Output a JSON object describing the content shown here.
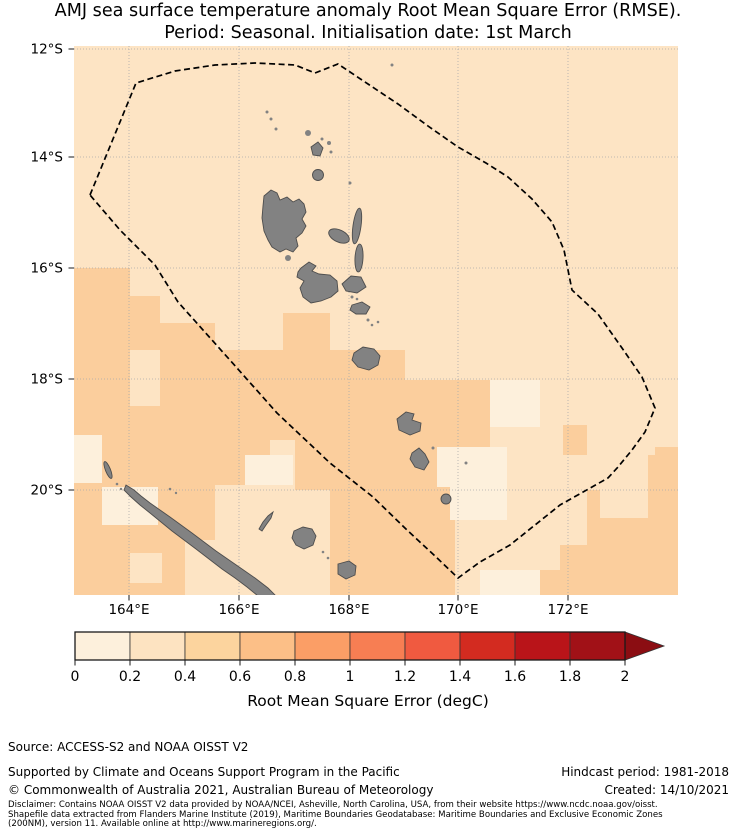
{
  "title": {
    "line1": "AMJ sea surface temperature anomaly Root Mean Square Error (RMSE).",
    "line2": "Period: Seasonal. Initialisation date: 1st March"
  },
  "map": {
    "lat_labels": [
      "12°S",
      "14°S",
      "16°S",
      "18°S",
      "20°S"
    ],
    "lon_labels": [
      "164°E",
      "166°E",
      "168°E",
      "170°E",
      "172°E"
    ],
    "region_names": {
      "eez_boundary": "Vanuatu / New Caledonia EEZ dashed boundary",
      "islands": "Vanuatu archipelago and New Caledonia (land, grey)"
    }
  },
  "map_colors": {
    "rmse_0_02": "#FDF0DC",
    "rmse_02_04": "#FDE4C4",
    "rmse_04_06": "#FBCE9D",
    "land": "#828282",
    "land_outline": "#4D4D4D",
    "gridline": "#AAAAAA",
    "eez_boundary": "#000000",
    "tick": "#1A1A1A"
  },
  "colorbar": {
    "tick_labels": [
      "0",
      "0.2",
      "0.4",
      "0.6",
      "0.8",
      "1",
      "1.2",
      "1.4",
      "1.6",
      "1.8",
      "2"
    ],
    "label": "Root Mean Square Error (degC)",
    "colors": [
      "#FDF0DC",
      "#FDE3C1",
      "#FCD49E",
      "#FCBF87",
      "#FB9E66",
      "#F77E53",
      "#F05A40",
      "#D32B20",
      "#B91419",
      "#A11117"
    ],
    "arrow_color": "#8B0D12"
  },
  "footer": {
    "source": "Source: ACCESS-S2 and NOAA OISST V2",
    "supported": "Supported by Climate and Oceans Support Program in the Pacific",
    "copyright": "© Commonwealth of Australia 2021, Australian Bureau of Meteorology",
    "hindcast": "Hindcast period: 1981-2018",
    "created": "Created: 14/10/2021",
    "disclaimer_line1": "Disclaimer: Contains NOAA OISST V2 data provided by NOAA/NCEI, Asheville, North Carolina, USA, from their website https://www.ncdc.noaa.gov/oisst.",
    "disclaimer_line2": "Shapefile data extracted from Flanders Marine Institute (2019), Maritime Boundaries Geodatabase: Maritime Boundaries and Exclusive Economic Zones",
    "disclaimer_line3": "(200NM), version 11. Available online at http://www.marineregions.org/."
  }
}
